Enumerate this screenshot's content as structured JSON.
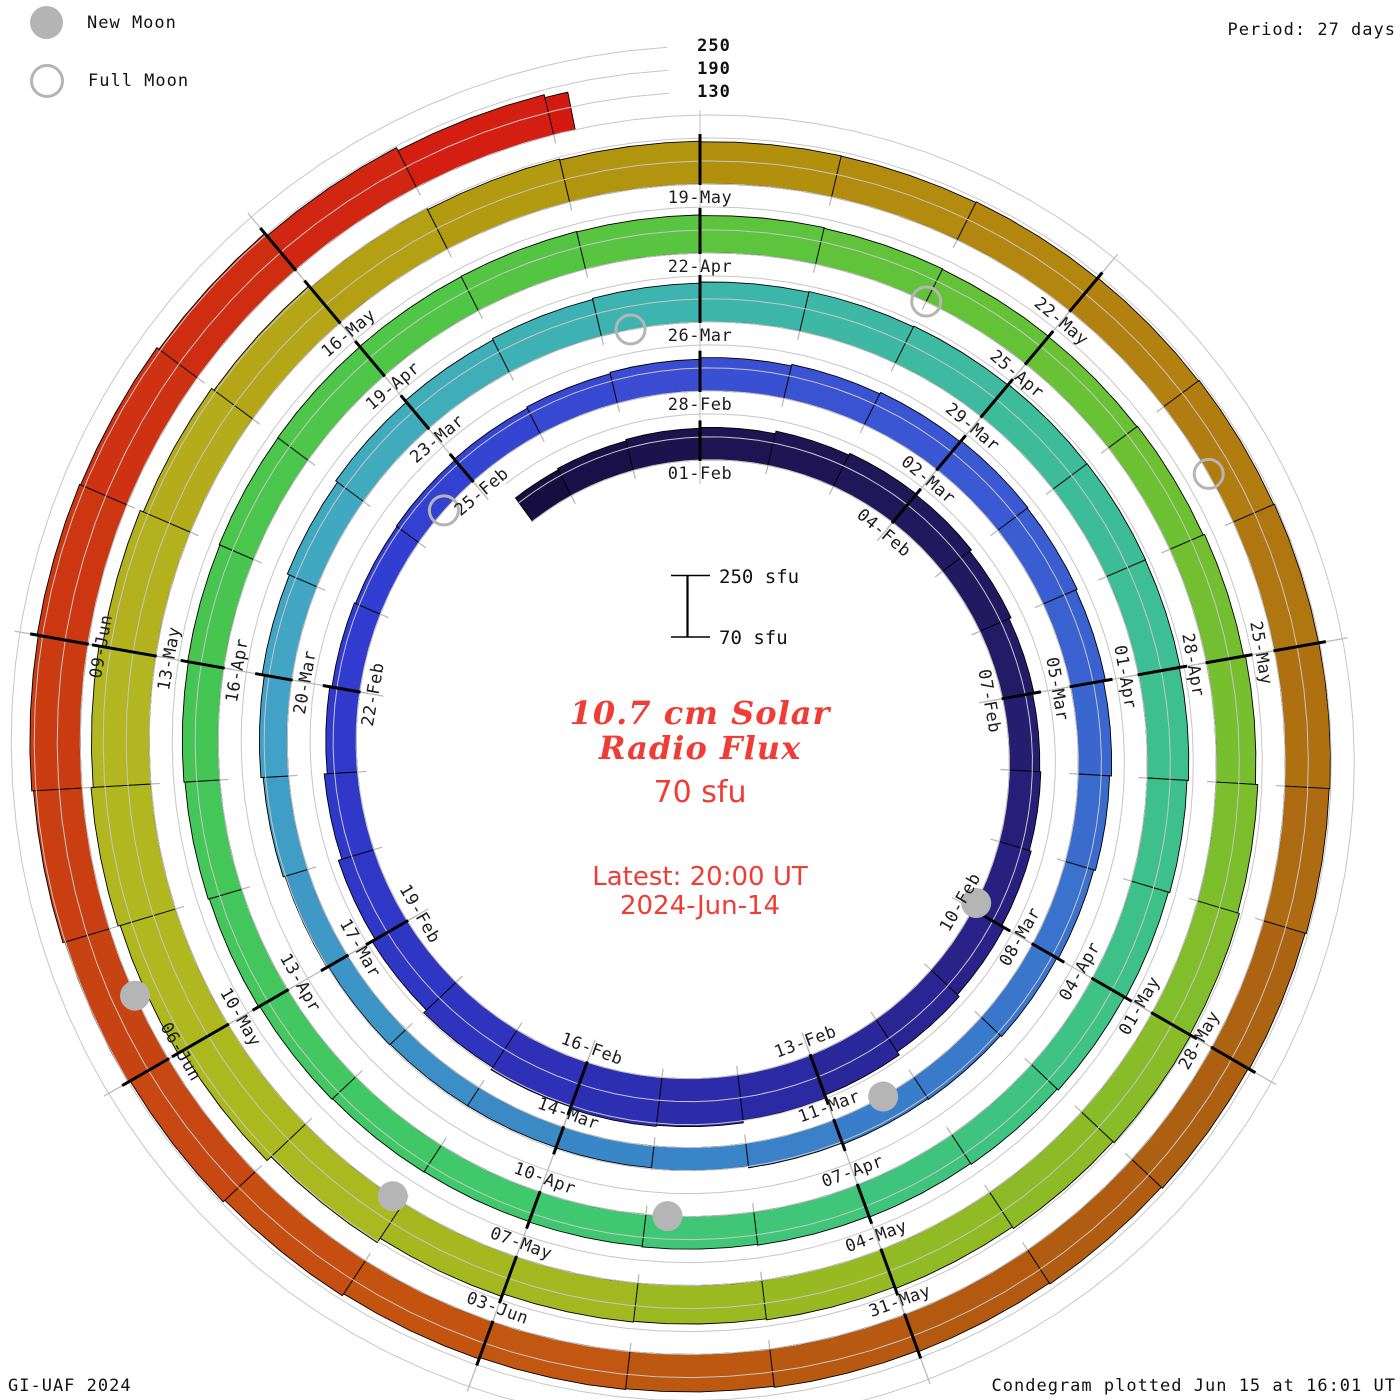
{
  "legend": {
    "new_moon_label": "New Moon",
    "full_moon_label": "Full Moon"
  },
  "header": {
    "period_label": "Period: 27 days"
  },
  "radial_scale": {
    "labels": [
      "250",
      "190",
      "130"
    ]
  },
  "scale_bar": {
    "top_label": "250 sfu",
    "bottom_label": "70 sfu"
  },
  "center": {
    "title_line1": "10.7 cm Solar",
    "title_line2": "Radio Flux",
    "baseline_label": "70 sfu",
    "latest_line1": "Latest: 20:00 UT",
    "latest_line2": "2024-Jun-14"
  },
  "footer": {
    "left": "GI-UAF 2024",
    "right": "Condegram plotted Jun 15 at 16:01 UT"
  },
  "colors": {
    "accent_red": "#ef3d36",
    "moon_gray": "#b5b5b5",
    "grid_gray": "#c6c6c6",
    "spoke_gray": "#bdbdbd",
    "day_tick_gray": "#b4b4b4",
    "label_black": "#1c1c1c"
  },
  "chart_data": {
    "type": "bar",
    "subtype": "condegram-spiral",
    "title": "10.7 cm Solar Radio Flux",
    "units": "sfu",
    "period_days": 27,
    "epoch_date": "2024-02-01",
    "start_date": "2024-01-29",
    "end_date": "2024-06-14",
    "latest_time": "20:00 UT",
    "data_start_day_offset": -2.7,
    "data_end_day_offset": 134.15,
    "flux_baseline_sfu": 70,
    "radial_gridlines_sfu": [
      130,
      190,
      250
    ],
    "date_labels": [
      [
        0,
        "01-Feb"
      ],
      [
        3,
        "04-Feb"
      ],
      [
        6,
        "07-Feb"
      ],
      [
        9,
        "10-Feb"
      ],
      [
        12,
        "13-Feb"
      ],
      [
        15,
        "16-Feb"
      ],
      [
        18,
        "19-Feb"
      ],
      [
        21,
        "22-Feb"
      ],
      [
        24,
        "25-Feb"
      ],
      [
        27,
        "28-Feb"
      ],
      [
        30,
        "02-Mar"
      ],
      [
        33,
        "05-Mar"
      ],
      [
        36,
        "08-Mar"
      ],
      [
        39,
        "11-Mar"
      ],
      [
        42,
        "14-Mar"
      ],
      [
        45,
        "17-Mar"
      ],
      [
        48,
        "20-Mar"
      ],
      [
        51,
        "23-Mar"
      ],
      [
        54,
        "26-Mar"
      ],
      [
        57,
        "29-Mar"
      ],
      [
        60,
        "01-Apr"
      ],
      [
        63,
        "04-Apr"
      ],
      [
        66,
        "07-Apr"
      ],
      [
        69,
        "10-Apr"
      ],
      [
        72,
        "13-Apr"
      ],
      [
        75,
        "16-Apr"
      ],
      [
        78,
        "19-Apr"
      ],
      [
        81,
        "22-Apr"
      ],
      [
        84,
        "25-Apr"
      ],
      [
        87,
        "28-Apr"
      ],
      [
        90,
        "01-May"
      ],
      [
        93,
        "04-May"
      ],
      [
        96,
        "07-May"
      ],
      [
        99,
        "10-May"
      ],
      [
        102,
        "13-May"
      ],
      [
        105,
        "16-May"
      ],
      [
        108,
        "19-May"
      ],
      [
        111,
        "22-May"
      ],
      [
        114,
        "25-May"
      ],
      [
        117,
        "28-May"
      ],
      [
        120,
        "31-May"
      ],
      [
        123,
        "03-Jun"
      ],
      [
        126,
        "06-Jun"
      ],
      [
        129,
        "09-Jun"
      ]
    ],
    "daily_flux_start_day": -3,
    "daily_flux": [
      148,
      152,
      156,
      158,
      165,
      170,
      168,
      162,
      156,
      152,
      155,
      160,
      168,
      175,
      185,
      193,
      200,
      203,
      198,
      190,
      180,
      170,
      160,
      152,
      146,
      143,
      145,
      148,
      152,
      156,
      160,
      164,
      168,
      172,
      170,
      166,
      160,
      155,
      150,
      146,
      142,
      140,
      136,
      132,
      129,
      128,
      128,
      130,
      134,
      139,
      145,
      151,
      157,
      163,
      168,
      172,
      175,
      178,
      180,
      182,
      184,
      185,
      184,
      182,
      178,
      174,
      170,
      166,
      163,
      160,
      158,
      156,
      155,
      156,
      158,
      161,
      164,
      167,
      169,
      171,
      172,
      173,
      174,
      173,
      171,
      169,
      167,
      166,
      168,
      172,
      177,
      183,
      188,
      191,
      187,
      182,
      177,
      174,
      176,
      184,
      198,
      213,
      226,
      232,
      226,
      217,
      208,
      200,
      194,
      189,
      186,
      184,
      183,
      185,
      187,
      189,
      191,
      192,
      190,
      187,
      184,
      180,
      177,
      174,
      171,
      173,
      177,
      183,
      189,
      195,
      201,
      206,
      209,
      206,
      199,
      190,
      181,
      173
    ],
    "colormap": [
      [
        -3,
        "#150c3e"
      ],
      [
        0,
        "#1d1350"
      ],
      [
        5,
        "#231a62"
      ],
      [
        9,
        "#272184"
      ],
      [
        13,
        "#2b2ba8"
      ],
      [
        17,
        "#2f35c2"
      ],
      [
        21,
        "#3139cf"
      ],
      [
        24,
        "#3343d2"
      ],
      [
        27,
        "#3a4ed2"
      ],
      [
        30,
        "#3a57d2"
      ],
      [
        33,
        "#3a63d0"
      ],
      [
        36,
        "#3a75cc"
      ],
      [
        39,
        "#3a7fc9"
      ],
      [
        42,
        "#3a88c6"
      ],
      [
        45,
        "#3e96c6"
      ],
      [
        48,
        "#42a3c6"
      ],
      [
        51,
        "#40adbb"
      ],
      [
        54,
        "#3cb5ac"
      ],
      [
        57,
        "#3dbb9c"
      ],
      [
        60,
        "#3dbe92"
      ],
      [
        63,
        "#3ec187"
      ],
      [
        66,
        "#3fc57b"
      ],
      [
        69,
        "#3fc96e"
      ],
      [
        72,
        "#42c75e"
      ],
      [
        75,
        "#45c552"
      ],
      [
        78,
        "#4ec647"
      ],
      [
        81,
        "#5ac43e"
      ],
      [
        84,
        "#66c136"
      ],
      [
        87,
        "#75bf30"
      ],
      [
        90,
        "#85bc2a"
      ],
      [
        93,
        "#95ba24"
      ],
      [
        96,
        "#a3b81f"
      ],
      [
        99,
        "#aeb91e"
      ],
      [
        102,
        "#b3b520"
      ],
      [
        105,
        "#b4a314"
      ],
      [
        108,
        "#b2920e"
      ],
      [
        111,
        "#b2840f"
      ],
      [
        114,
        "#b07410"
      ],
      [
        117,
        "#ac6112"
      ],
      [
        120,
        "#b45910"
      ],
      [
        123,
        "#c45610"
      ],
      [
        126,
        "#c74512"
      ],
      [
        129,
        "#cb3911"
      ],
      [
        132,
        "#d02a12"
      ],
      [
        134,
        "#d41a10"
      ]
    ],
    "new_moons": [
      {
        "date": "2024-02-09",
        "day": 8.9
      },
      {
        "date": "2024-03-10",
        "day": 38.4
      },
      {
        "date": "2024-04-08",
        "day": 67.8
      },
      {
        "date": "2024-05-08",
        "day": 97.1
      },
      {
        "date": "2024-06-06",
        "day": 126.5
      }
    ],
    "full_moons": [
      {
        "date": "2024-02-24",
        "day": 23.5
      },
      {
        "date": "2024-03-25",
        "day": 53.3
      },
      {
        "date": "2024-04-23",
        "day": 83.0
      },
      {
        "date": "2024-05-23",
        "day": 112.6
      }
    ]
  }
}
